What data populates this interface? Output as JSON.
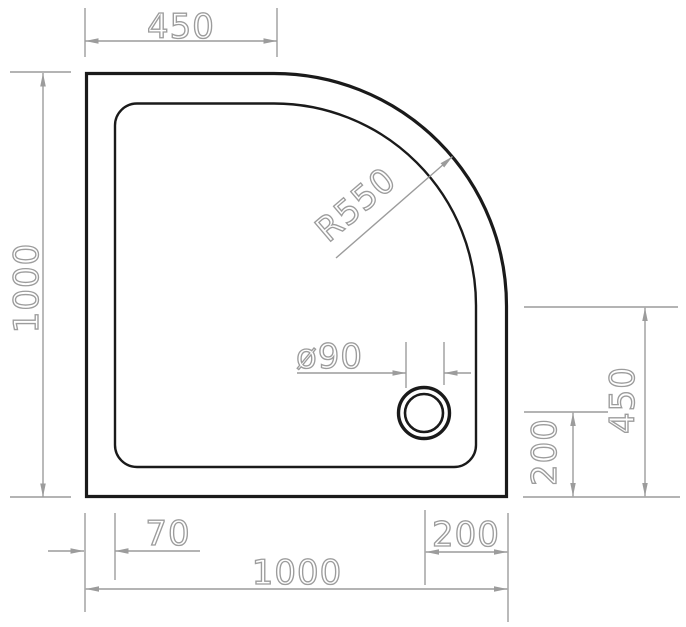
{
  "labels": {
    "top_width": "450",
    "left_height": "1000",
    "corner_radius": "R550",
    "drain_diameter": "ø90",
    "right_offset_450": "450",
    "right_offset_200": "200",
    "bottom_offset_70": "70",
    "bottom_offset_200": "200",
    "bottom_width": "1000"
  },
  "colors": {
    "outline": "#1a1a1a",
    "dimension": "#9c9c9c",
    "background": "#ffffff"
  }
}
